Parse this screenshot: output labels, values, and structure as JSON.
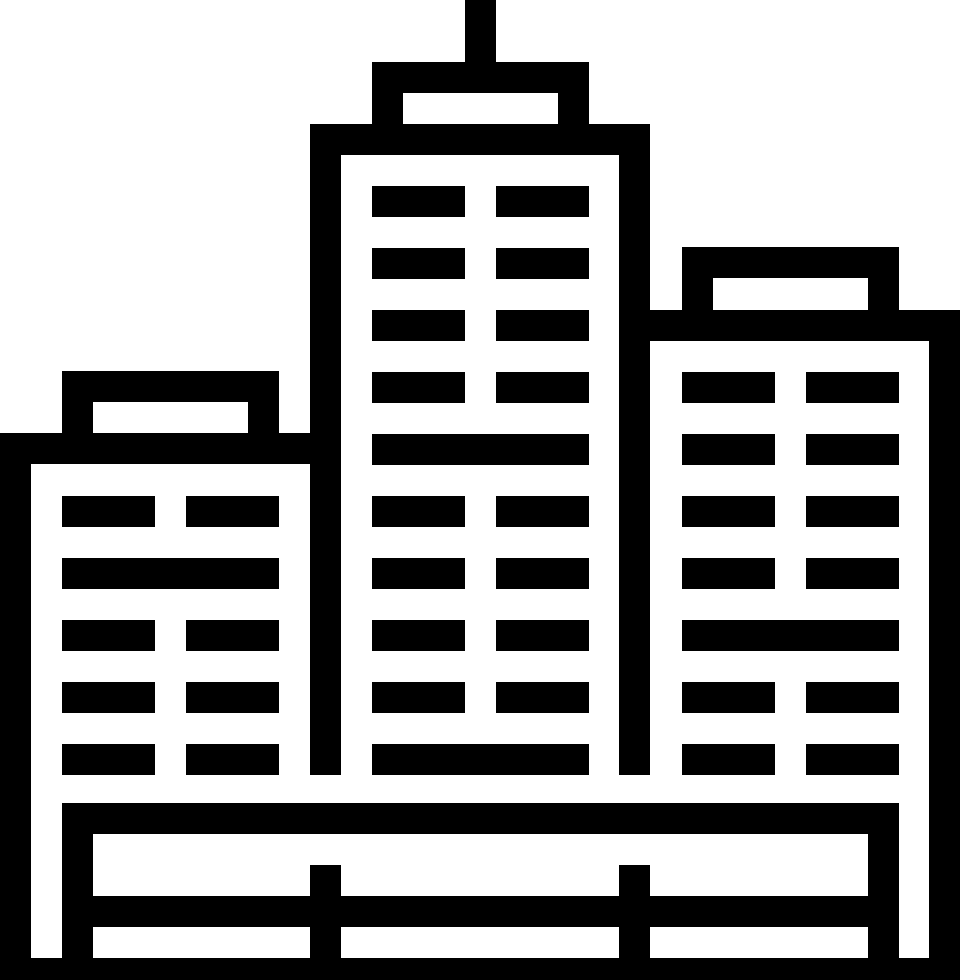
{
  "icon": {
    "title": "city buildings skyline icon",
    "color": "#000000",
    "background": "#ffffff",
    "viewbox": {
      "width": 960,
      "height": 980
    },
    "shapes": [
      {
        "name": "center-antenna",
        "x": 465,
        "y": 0,
        "w": 31,
        "h": 93
      },
      {
        "name": "center-cap-top",
        "x": 372,
        "y": 62,
        "w": 217,
        "h": 31
      },
      {
        "name": "center-cap-pillar-left",
        "x": 372,
        "y": 93,
        "w": 31,
        "h": 31
      },
      {
        "name": "center-cap-pillar-right",
        "x": 558,
        "y": 93,
        "w": 31,
        "h": 31
      },
      {
        "name": "center-roof-band",
        "x": 310,
        "y": 124,
        "w": 340,
        "h": 31
      },
      {
        "name": "center-wall-left",
        "x": 310,
        "y": 155,
        "w": 31,
        "h": 620
      },
      {
        "name": "center-wall-right",
        "x": 619,
        "y": 155,
        "w": 31,
        "h": 620
      },
      {
        "name": "center-window-r1-left",
        "x": 372,
        "y": 186,
        "w": 93,
        "h": 31
      },
      {
        "name": "center-window-r1-right",
        "x": 496,
        "y": 186,
        "w": 93,
        "h": 31
      },
      {
        "name": "center-window-r2-left",
        "x": 372,
        "y": 248,
        "w": 93,
        "h": 31
      },
      {
        "name": "center-window-r2-right",
        "x": 496,
        "y": 248,
        "w": 93,
        "h": 31
      },
      {
        "name": "center-window-r3-left",
        "x": 372,
        "y": 310,
        "w": 93,
        "h": 31
      },
      {
        "name": "center-window-r3-right",
        "x": 496,
        "y": 310,
        "w": 93,
        "h": 31
      },
      {
        "name": "center-window-r4-left",
        "x": 372,
        "y": 372,
        "w": 93,
        "h": 31
      },
      {
        "name": "center-window-r4-right",
        "x": 496,
        "y": 372,
        "w": 93,
        "h": 31
      },
      {
        "name": "center-window-r5-wide",
        "x": 372,
        "y": 434,
        "w": 217,
        "h": 31
      },
      {
        "name": "center-window-r6-left",
        "x": 372,
        "y": 496,
        "w": 93,
        "h": 31
      },
      {
        "name": "center-window-r6-right",
        "x": 496,
        "y": 496,
        "w": 93,
        "h": 31
      },
      {
        "name": "center-window-r7-left",
        "x": 372,
        "y": 558,
        "w": 93,
        "h": 31
      },
      {
        "name": "center-window-r7-right",
        "x": 496,
        "y": 558,
        "w": 93,
        "h": 31
      },
      {
        "name": "center-window-r8-left",
        "x": 372,
        "y": 620,
        "w": 93,
        "h": 31
      },
      {
        "name": "center-window-r8-right",
        "x": 496,
        "y": 620,
        "w": 93,
        "h": 31
      },
      {
        "name": "center-window-r9-left",
        "x": 372,
        "y": 682,
        "w": 93,
        "h": 31
      },
      {
        "name": "center-window-r9-right",
        "x": 496,
        "y": 682,
        "w": 93,
        "h": 31
      },
      {
        "name": "center-window-r10-wide",
        "x": 372,
        "y": 744,
        "w": 217,
        "h": 31
      },
      {
        "name": "left-cap-top",
        "x": 62,
        "y": 371,
        "w": 217,
        "h": 31
      },
      {
        "name": "left-cap-pillar-left",
        "x": 62,
        "y": 402,
        "w": 31,
        "h": 31
      },
      {
        "name": "left-cap-pillar-right",
        "x": 248,
        "y": 402,
        "w": 31,
        "h": 31
      },
      {
        "name": "left-roof-band",
        "x": 0,
        "y": 433,
        "w": 310,
        "h": 31
      },
      {
        "name": "left-wall-outer",
        "x": 0,
        "y": 464,
        "w": 31,
        "h": 494
      },
      {
        "name": "left-window-r1-left",
        "x": 62,
        "y": 496,
        "w": 93,
        "h": 31
      },
      {
        "name": "left-window-r1-right",
        "x": 186,
        "y": 496,
        "w": 93,
        "h": 31
      },
      {
        "name": "left-window-r2-wide",
        "x": 62,
        "y": 558,
        "w": 217,
        "h": 31
      },
      {
        "name": "left-window-r3-left",
        "x": 62,
        "y": 620,
        "w": 93,
        "h": 31
      },
      {
        "name": "left-window-r3-right",
        "x": 186,
        "y": 620,
        "w": 93,
        "h": 31
      },
      {
        "name": "left-window-r4-left",
        "x": 62,
        "y": 682,
        "w": 93,
        "h": 31
      },
      {
        "name": "left-window-r4-right",
        "x": 186,
        "y": 682,
        "w": 93,
        "h": 31
      },
      {
        "name": "left-window-r5-left",
        "x": 62,
        "y": 744,
        "w": 93,
        "h": 31
      },
      {
        "name": "left-window-r5-right",
        "x": 186,
        "y": 744,
        "w": 93,
        "h": 31
      },
      {
        "name": "right-cap-top",
        "x": 682,
        "y": 247,
        "w": 217,
        "h": 31
      },
      {
        "name": "right-cap-pillar-left",
        "x": 682,
        "y": 278,
        "w": 31,
        "h": 32
      },
      {
        "name": "right-cap-pillar-right",
        "x": 868,
        "y": 278,
        "w": 31,
        "h": 32
      },
      {
        "name": "right-roof-band",
        "x": 650,
        "y": 310,
        "w": 310,
        "h": 31
      },
      {
        "name": "right-wall-outer",
        "x": 929,
        "y": 341,
        "w": 31,
        "h": 617
      },
      {
        "name": "right-window-r1-left",
        "x": 682,
        "y": 372,
        "w": 93,
        "h": 31
      },
      {
        "name": "right-window-r1-right",
        "x": 806,
        "y": 372,
        "w": 93,
        "h": 31
      },
      {
        "name": "right-window-r2-left",
        "x": 682,
        "y": 434,
        "w": 93,
        "h": 31
      },
      {
        "name": "right-window-r2-right",
        "x": 806,
        "y": 434,
        "w": 93,
        "h": 31
      },
      {
        "name": "right-window-r3-left",
        "x": 682,
        "y": 496,
        "w": 93,
        "h": 31
      },
      {
        "name": "right-window-r3-right",
        "x": 806,
        "y": 496,
        "w": 93,
        "h": 31
      },
      {
        "name": "right-window-r4-left",
        "x": 682,
        "y": 558,
        "w": 93,
        "h": 31
      },
      {
        "name": "right-window-r4-right",
        "x": 806,
        "y": 558,
        "w": 93,
        "h": 31
      },
      {
        "name": "right-window-r5-wide",
        "x": 682,
        "y": 620,
        "w": 217,
        "h": 31
      },
      {
        "name": "right-window-r6-left",
        "x": 682,
        "y": 682,
        "w": 93,
        "h": 31
      },
      {
        "name": "right-window-r6-right",
        "x": 806,
        "y": 682,
        "w": 93,
        "h": 31
      },
      {
        "name": "right-window-r7-left",
        "x": 682,
        "y": 744,
        "w": 93,
        "h": 31
      },
      {
        "name": "right-window-r7-right",
        "x": 806,
        "y": 744,
        "w": 93,
        "h": 31
      },
      {
        "name": "base-platform",
        "x": 62,
        "y": 803,
        "w": 837,
        "h": 31
      },
      {
        "name": "base-support-left",
        "x": 62,
        "y": 834,
        "w": 31,
        "h": 124
      },
      {
        "name": "base-support-right",
        "x": 868,
        "y": 834,
        "w": 31,
        "h": 124
      },
      {
        "name": "base-rail",
        "x": 62,
        "y": 896,
        "w": 837,
        "h": 31
      },
      {
        "name": "base-post-left",
        "x": 310,
        "y": 865,
        "w": 31,
        "h": 93
      },
      {
        "name": "base-post-right",
        "x": 619,
        "y": 865,
        "w": 31,
        "h": 93
      },
      {
        "name": "base-ground",
        "x": 0,
        "y": 958,
        "w": 960,
        "h": 22
      }
    ]
  }
}
